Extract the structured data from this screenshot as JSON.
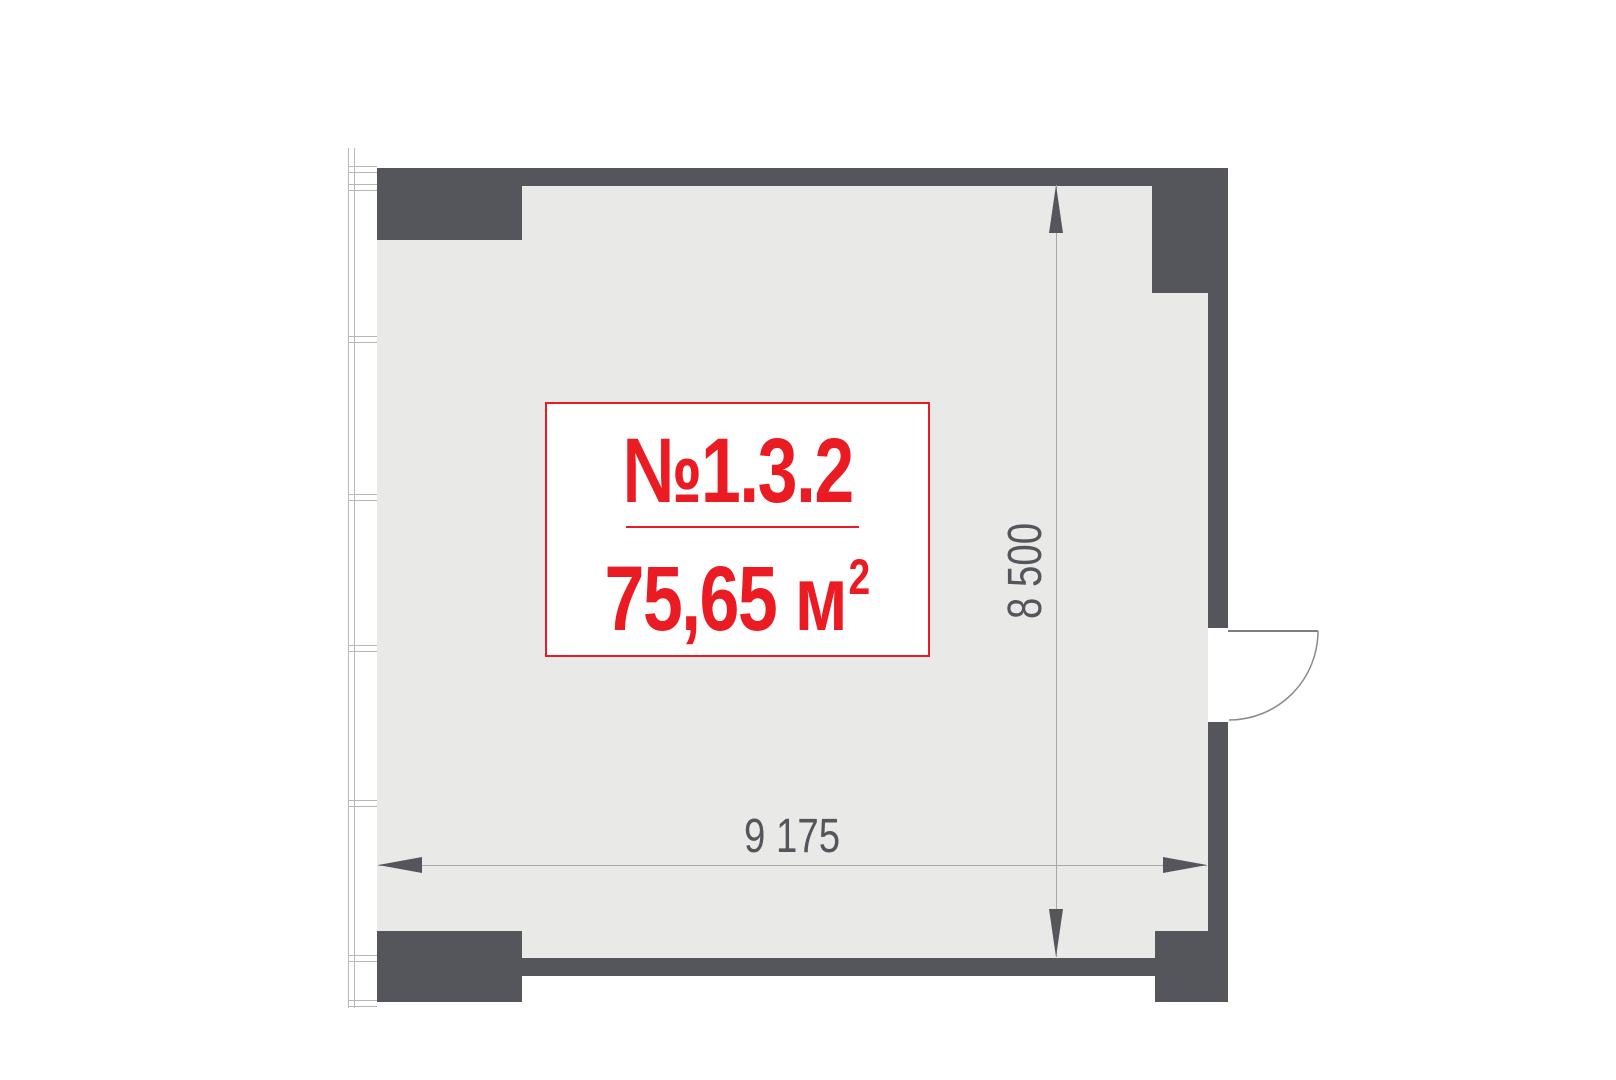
{
  "unit": {
    "number": "№1.3.2",
    "area_main": "75,65 м",
    "area_sup": "2"
  },
  "dimensions": {
    "width_label": "9 175",
    "height_label": "8 500"
  },
  "colors": {
    "wall": "#54565b",
    "floor": "#e9e9e8",
    "accent_red": "#ea1b22",
    "dimension_gray": "#a8a8a8",
    "window_frame_gray": "#b7b7b7"
  }
}
